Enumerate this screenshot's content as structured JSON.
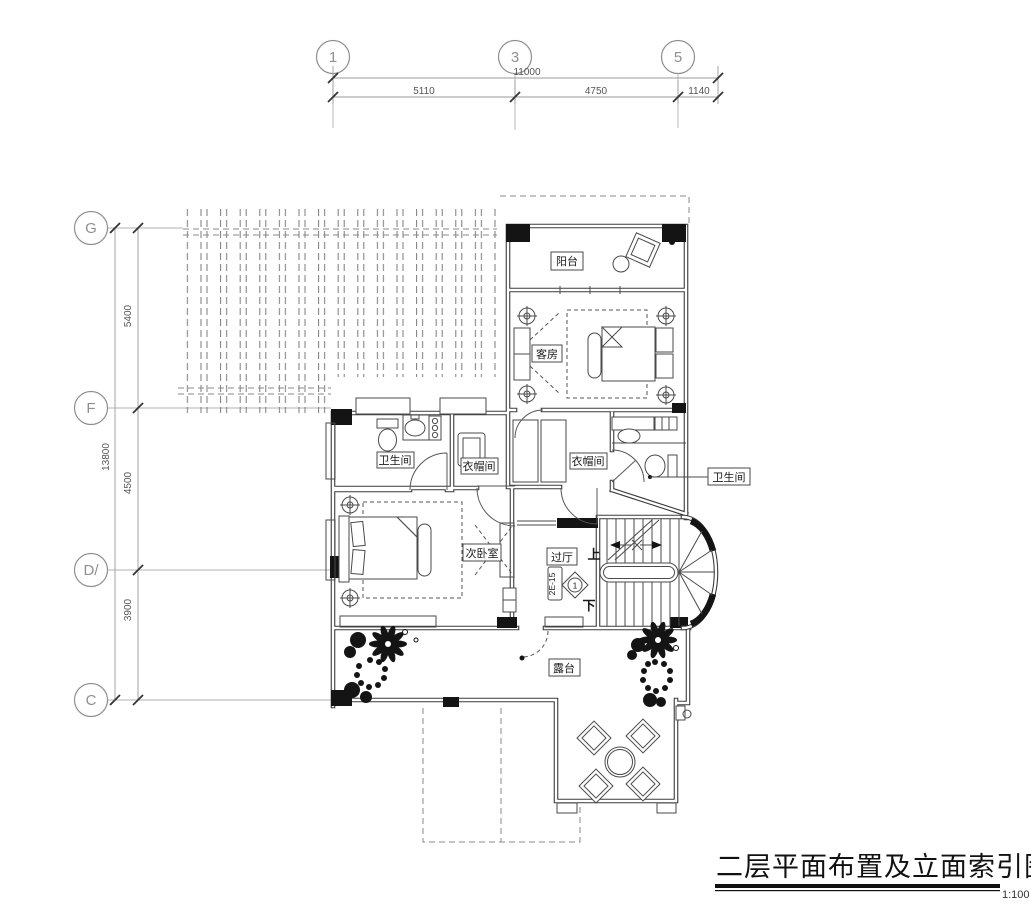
{
  "title": {
    "text": "二层平面布置及立面索引图",
    "scale": "1:100"
  },
  "grid": {
    "cols": [
      {
        "id": "1"
      },
      {
        "id": "3"
      },
      {
        "id": "5"
      }
    ],
    "rows": [
      {
        "id": "G"
      },
      {
        "id": "F"
      },
      {
        "id": "D/"
      },
      {
        "id": "C"
      }
    ],
    "dims_top": {
      "overall": "11000",
      "seg1": "5110",
      "seg2": "4750",
      "seg3": "1140"
    },
    "dims_left": {
      "overall": "13800",
      "seg1": "5400",
      "seg2": "4500",
      "seg3": "3900"
    }
  },
  "rooms": {
    "balcony": "阳台",
    "guest_room": "客房",
    "bath_left": "卫生间",
    "closet_left": "衣帽间",
    "closet_center": "衣帽间",
    "bath_right": "卫生间",
    "bedroom_second": "次卧室",
    "hall": "过厅",
    "terrace": "露台"
  },
  "stairs": {
    "up": "上",
    "down": "下"
  },
  "elevation_index": {
    "code": "2E-15",
    "number": "1"
  },
  "colors": {
    "ink": "#3a3a3a",
    "grid_gray": "#8f8f8f",
    "black_fill": "#141414"
  }
}
